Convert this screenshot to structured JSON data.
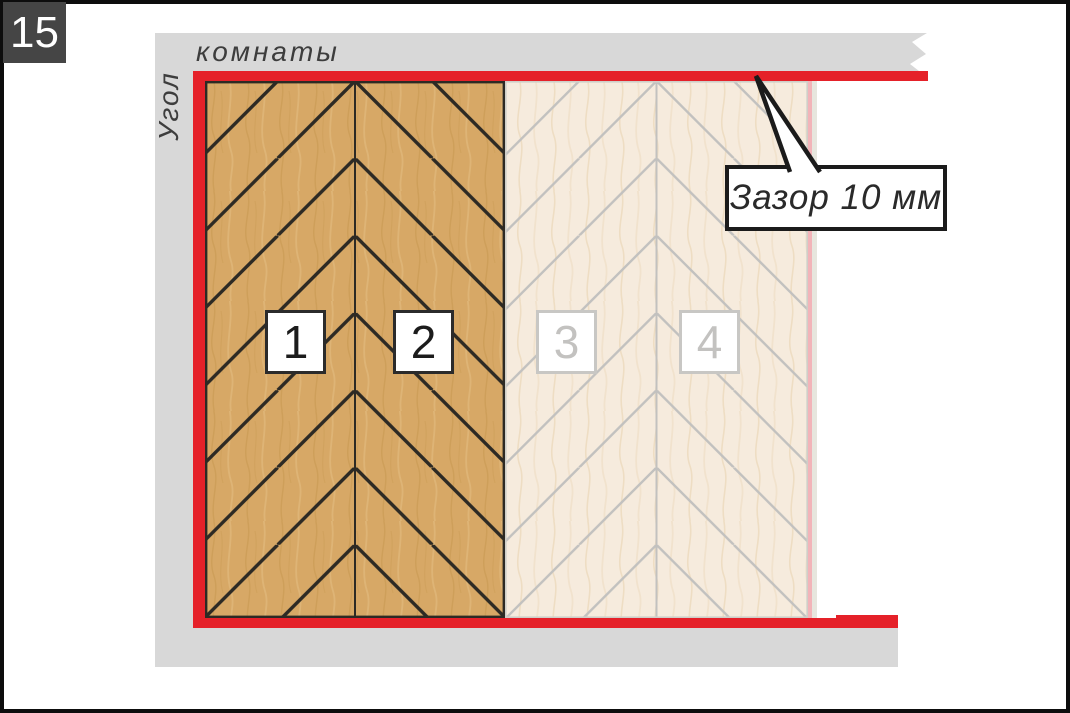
{
  "step_badge": {
    "number": "15"
  },
  "wall_labels": {
    "vertical": "Угол",
    "horizontal": "комнаты"
  },
  "callout": {
    "text": "Зазор 10 мм"
  },
  "plank_labels": [
    {
      "value": "1",
      "state": "laid"
    },
    {
      "value": "2",
      "state": "laid"
    },
    {
      "value": "3",
      "state": "planned"
    },
    {
      "value": "4",
      "state": "planned"
    }
  ],
  "colors": {
    "accent-red": "#e52129",
    "wall-gray": "#d8d8d8",
    "badge-bg": "#454545",
    "frame-black": "#0d0d0d",
    "text-dark": "#3d3d3d",
    "wood-dark": "#d7a866",
    "wood-dark-line": "#2d2a24",
    "wood-light": "#f6ebdd",
    "wood-light-line": "#c2c1bf",
    "edge-pink": "#f2b4b9",
    "edge-pale": "#e7e6de",
    "label-dark": "#2b2b2b",
    "label-faded": "#c8c7c4",
    "label-faded-text": "#c3c2c0",
    "callout-black": "#1b1b1b"
  }
}
